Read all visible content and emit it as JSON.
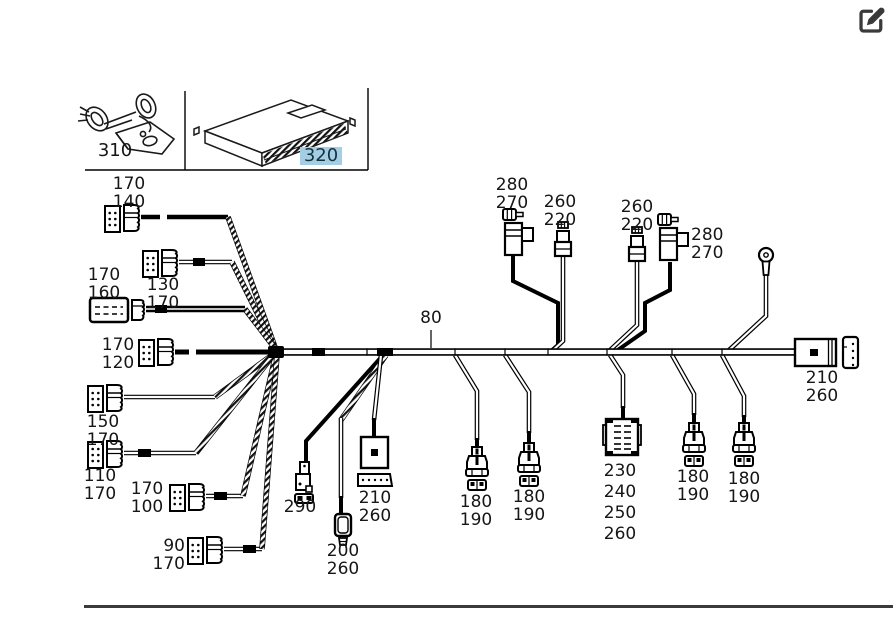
{
  "page": {
    "background": "#ffffff",
    "art_color": "#000000",
    "separator_color": "#3a3a3a",
    "highlight_color": "#a5cde3"
  },
  "toolbar": {
    "edit_button": {
      "icon": "pen-square-icon"
    }
  },
  "inset": {
    "parts": {
      "clip": {
        "callout": "310",
        "selected": false
      },
      "control_unit": {
        "callout": "320",
        "selected": true
      }
    }
  },
  "diagram": {
    "harness_callout": "80",
    "callouts": {
      "left_170_140": {
        "lines": [
          "170",
          "140"
        ]
      },
      "left_130_170": {
        "lines": [
          "130",
          "170"
        ]
      },
      "left_170_160": {
        "lines": [
          "170",
          "160"
        ]
      },
      "left_170_120": {
        "lines": [
          "170",
          "120"
        ]
      },
      "left_150_170": {
        "lines": [
          "150",
          "170"
        ]
      },
      "left_110_170": {
        "lines": [
          "110",
          "170"
        ]
      },
      "left_170_100": {
        "lines": [
          "170",
          "100"
        ]
      },
      "left_90_170": {
        "lines": [
          "90",
          "170"
        ]
      },
      "top_280_270_a": {
        "lines": [
          "280",
          "270"
        ]
      },
      "top_260_220_a": {
        "lines": [
          "260",
          "220"
        ]
      },
      "top_260_220_b": {
        "lines": [
          "260",
          "220"
        ]
      },
      "top_280_270_b": {
        "lines": [
          "280",
          "270"
        ]
      },
      "bottom_290": {
        "lines": [
          "290"
        ]
      },
      "bottom_200_260": {
        "lines": [
          "200",
          "260"
        ]
      },
      "bottom_210_260": {
        "lines": [
          "210",
          "260"
        ]
      },
      "bottom_180_190_a": {
        "lines": [
          "180",
          "190"
        ]
      },
      "bottom_180_190_b": {
        "lines": [
          "180",
          "190"
        ]
      },
      "bottom_230_240_250_260": {
        "lines": [
          "230",
          "240",
          "250",
          "260"
        ]
      },
      "bottom_180_190_c": {
        "lines": [
          "180",
          "190"
        ]
      },
      "bottom_180_190_d": {
        "lines": [
          "180",
          "190"
        ]
      },
      "right_210_260": {
        "lines": [
          "210",
          "260"
        ]
      }
    }
  }
}
